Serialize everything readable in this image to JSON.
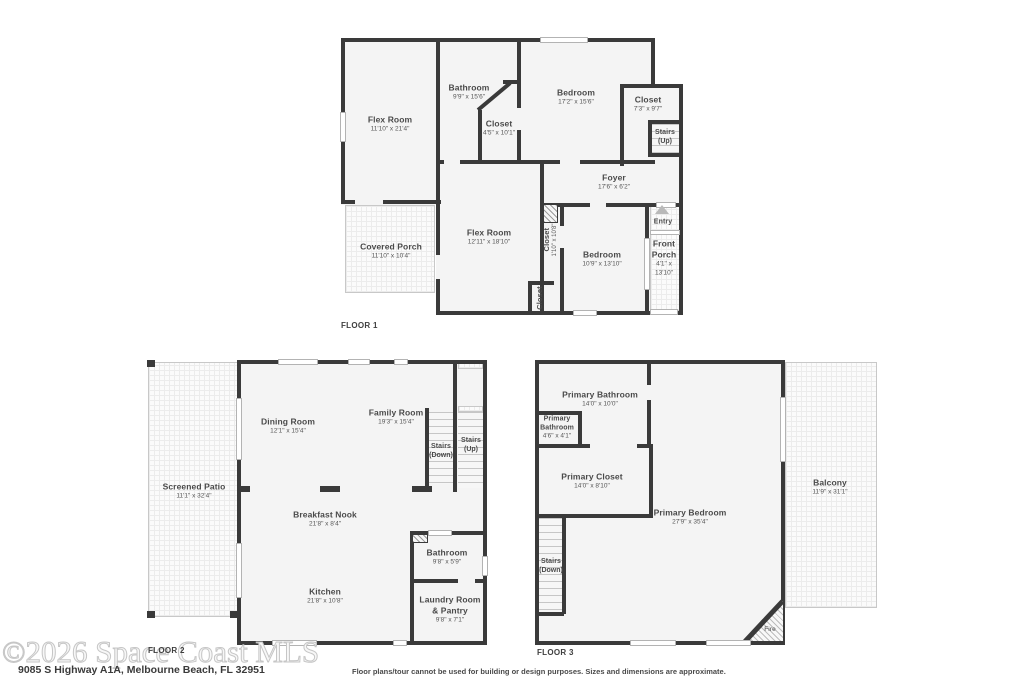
{
  "colors": {
    "wall": "#3a3a3a",
    "room_fill": "#f4f4f4",
    "label_text": "#4a4a4a",
    "watermark_outline": "#c6c6c6"
  },
  "f1": {
    "floor_label": "FLOOR 1",
    "flex1": {
      "name": "Flex Room",
      "dims": "11'10\" x 21'4\""
    },
    "bathroom": {
      "name": "Bathroom",
      "dims": "9'9\" x 15'6\""
    },
    "bath_closet": {
      "name": "Closet",
      "dims": "4'5\" x 10'1\""
    },
    "bedroom1": {
      "name": "Bedroom",
      "dims": "17'2\" x 15'6\""
    },
    "closet_ne": {
      "name": "Closet",
      "dims": "7'3\" x 9'7\""
    },
    "stairs_up": {
      "name": "Stairs",
      "dims": "(Up)"
    },
    "foyer": {
      "name": "Foyer",
      "dims": "17'6\" x 6'2\""
    },
    "flex2": {
      "name": "Flex Room",
      "dims": "12'11\" x 18'10\""
    },
    "closet_tall": {
      "name": "Closet",
      "dims": "1'10\" x 10'8\""
    },
    "closet_small": {
      "name": "Closet"
    },
    "bedroom2": {
      "name": "Bedroom",
      "dims": "10'9\" x 13'10\""
    },
    "covered_porch": {
      "name": "Covered Porch",
      "dims": "11'10\" x 10'4\""
    },
    "entry": {
      "name": "Entry"
    },
    "front_porch": {
      "name": "Front Porch",
      "dims": "4'1\" x 13'10\""
    }
  },
  "f2": {
    "floor_label": "FLOOR 2",
    "dining": {
      "name": "Dining Room",
      "dims": "12'1\" x 15'4\""
    },
    "family": {
      "name": "Family Room",
      "dims": "19'3\" x 15'4\""
    },
    "stairs_down": {
      "name": "Stairs",
      "dims": "(Down)"
    },
    "stairs_up": {
      "name": "Stairs",
      "dims": "(Up)"
    },
    "patio": {
      "name": "Screened Patio",
      "dims": "11'1\" x 32'4\""
    },
    "nook": {
      "name": "Breakfast Nook",
      "dims": "21'8\" x 8'4\""
    },
    "bathroom": {
      "name": "Bathroom",
      "dims": "9'8\" x 5'9\""
    },
    "kitchen": {
      "name": "Kitchen",
      "dims": "21'8\" x 10'8\""
    },
    "laundry": {
      "name": "Laundry Room & Pantry",
      "dims": "9'8\" x 7'1\""
    }
  },
  "f3": {
    "floor_label": "FLOOR 3",
    "primary_bath": {
      "name": "Primary Bathroom",
      "dims": "14'0\" x 10'0\""
    },
    "primary_bath_small": {
      "name": "Primary Bathroom",
      "dims": "4'6\" x 4'1\""
    },
    "primary_closet": {
      "name": "Primary Closet",
      "dims": "14'0\" x 8'10\""
    },
    "primary_bedroom": {
      "name": "Primary Bedroom",
      "dims": "27'9\" x 35'4\""
    },
    "stairs_down": {
      "name": "Stairs",
      "dims": "(Down)"
    },
    "balcony": {
      "name": "Balcony",
      "dims": "11'9\" x 31'1\""
    },
    "fire": {
      "name": "Fire"
    }
  },
  "footer": {
    "watermark": "©2026 Space Coast MLS",
    "address": "9085 S Highway A1A, Melbourne Beach, FL 32951",
    "disclaimer": "Floor plans/tour cannot be used for building or design purposes. Sizes and dimensions are approximate."
  }
}
